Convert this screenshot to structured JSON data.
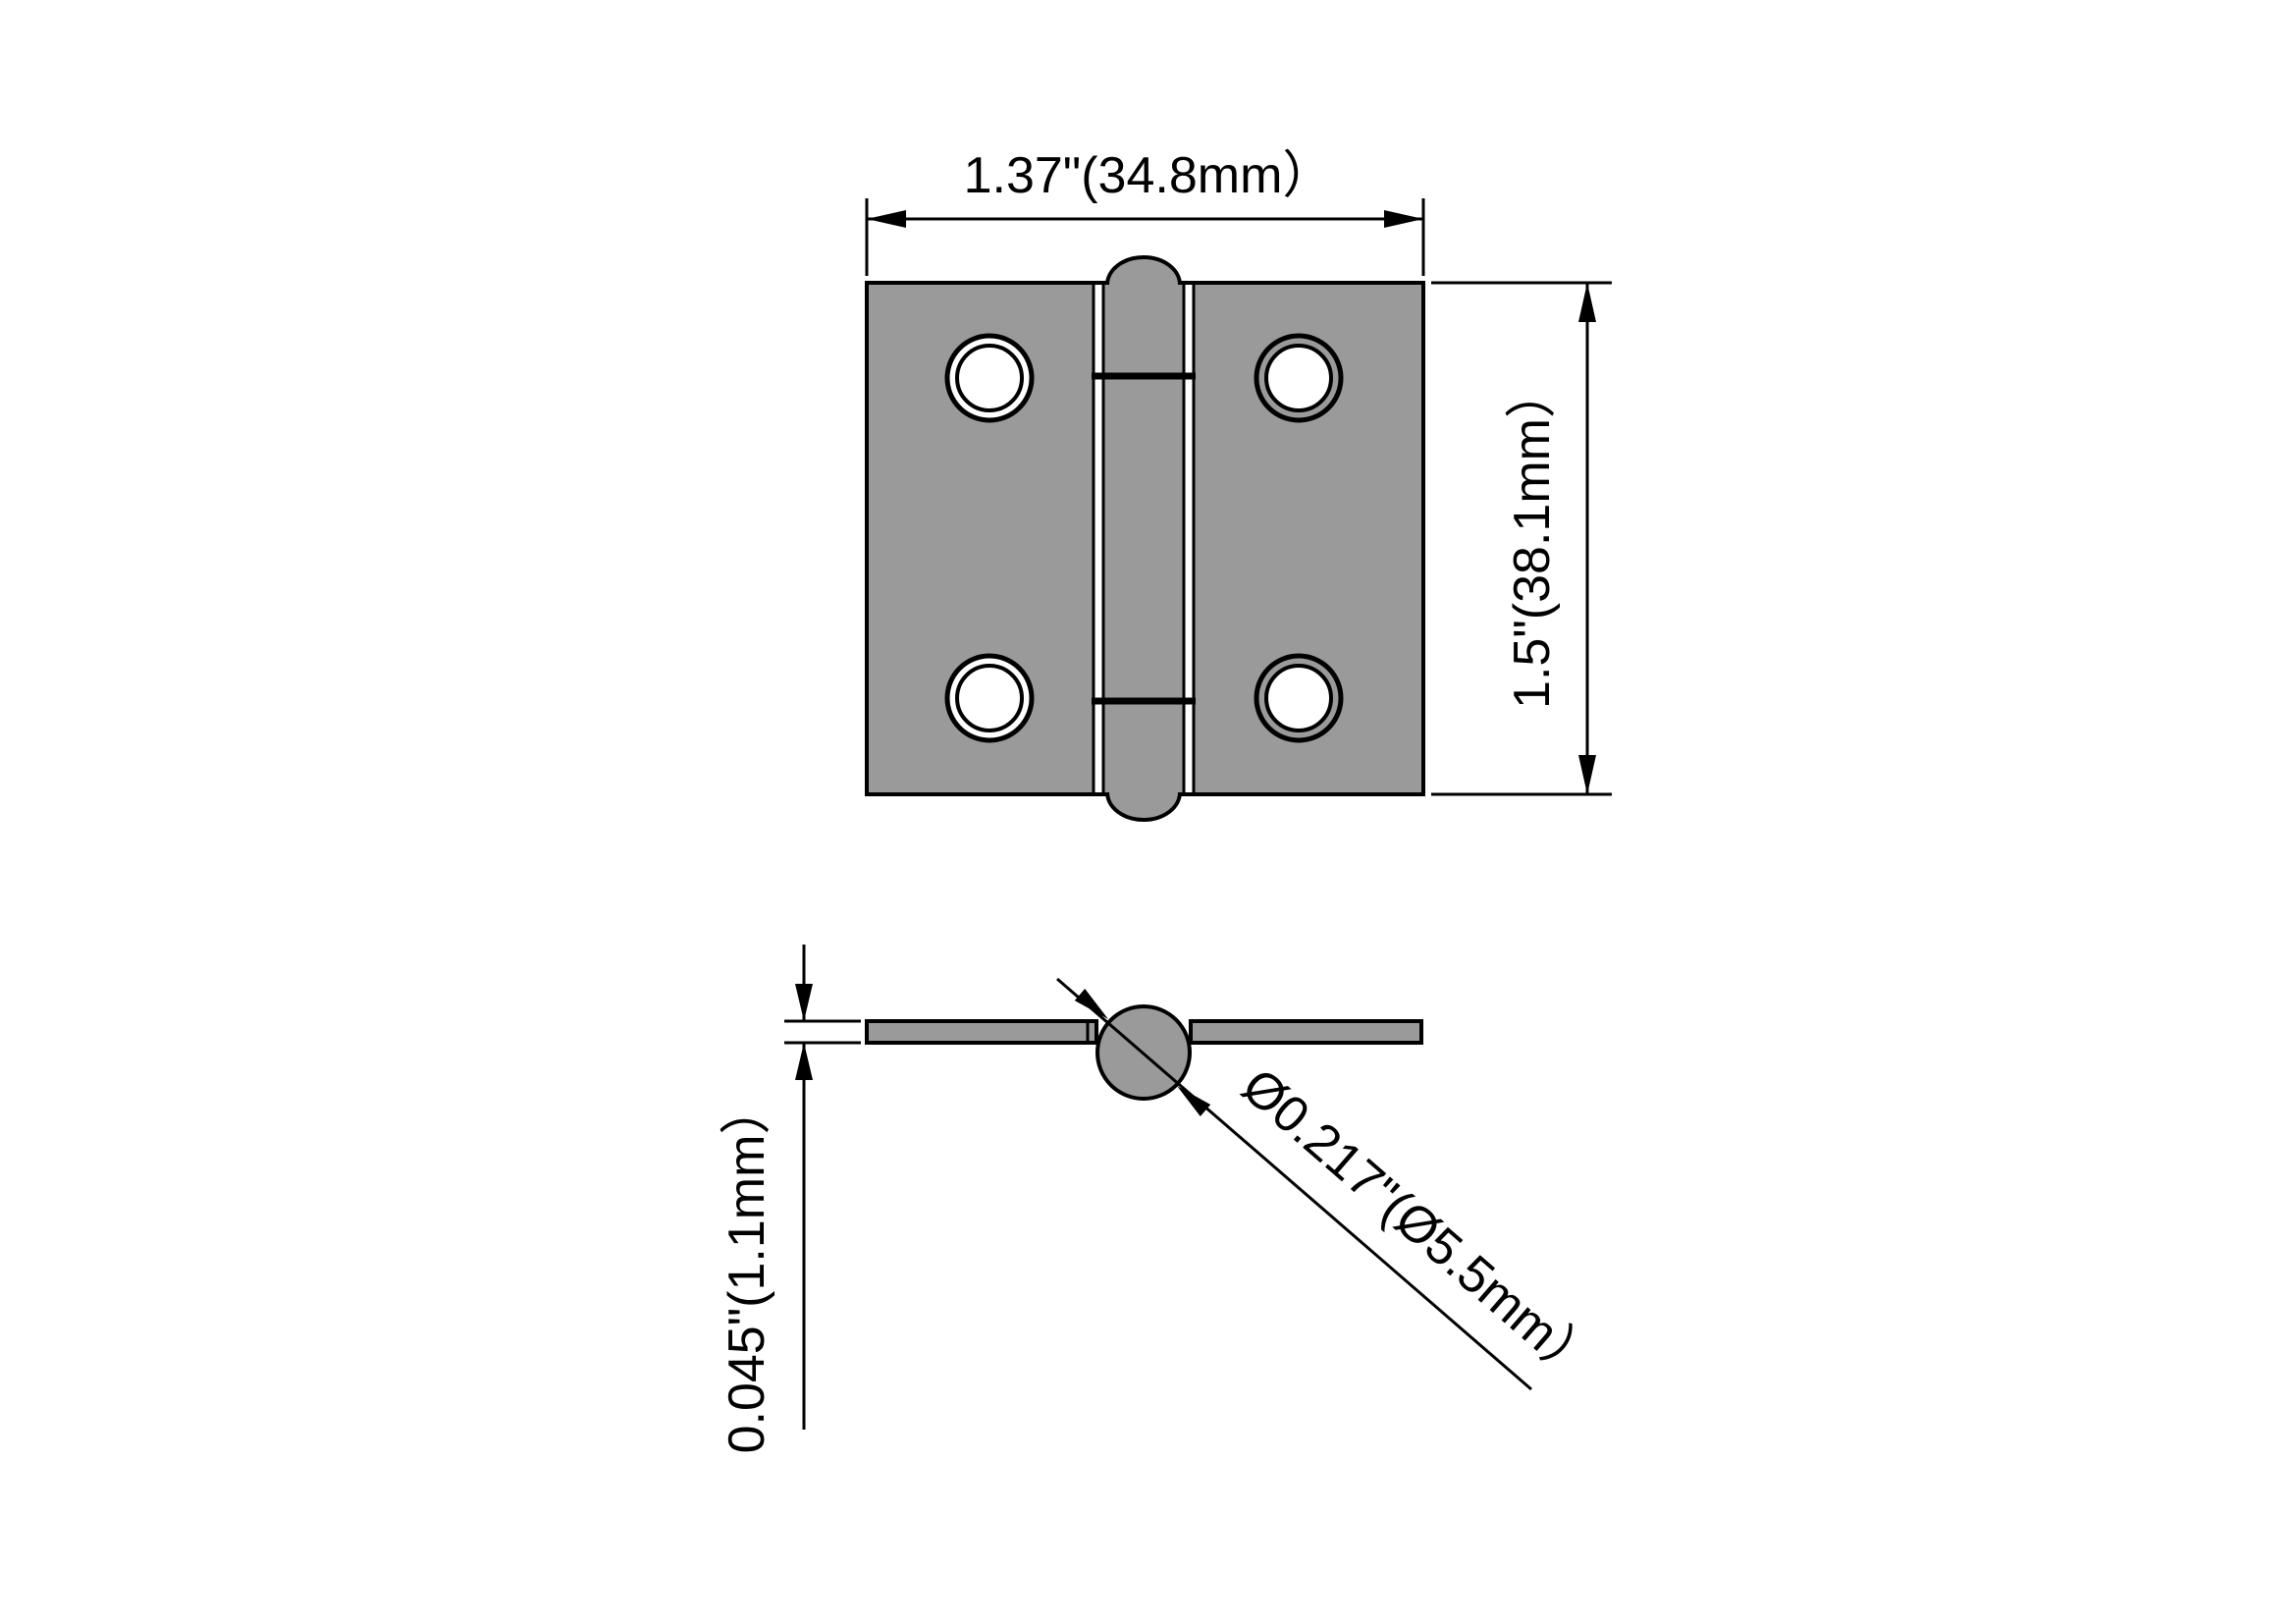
{
  "drawing": {
    "title": "hinge-technical-drawing",
    "colors": {
      "part_fill": "#9a9a9a",
      "line": "#000000",
      "background": "#ffffff"
    },
    "top_view": {
      "width_label": "1.37\"(34.8mm）",
      "height_label": "1.5\"(38.1mm）",
      "screw_hole_count": 4,
      "knuckle_segments": 3
    },
    "side_view": {
      "thickness_label": "0.045\"(1.1mm）",
      "pin_diameter_label": "Ø0.217\"(Ø5.5mm）"
    }
  }
}
